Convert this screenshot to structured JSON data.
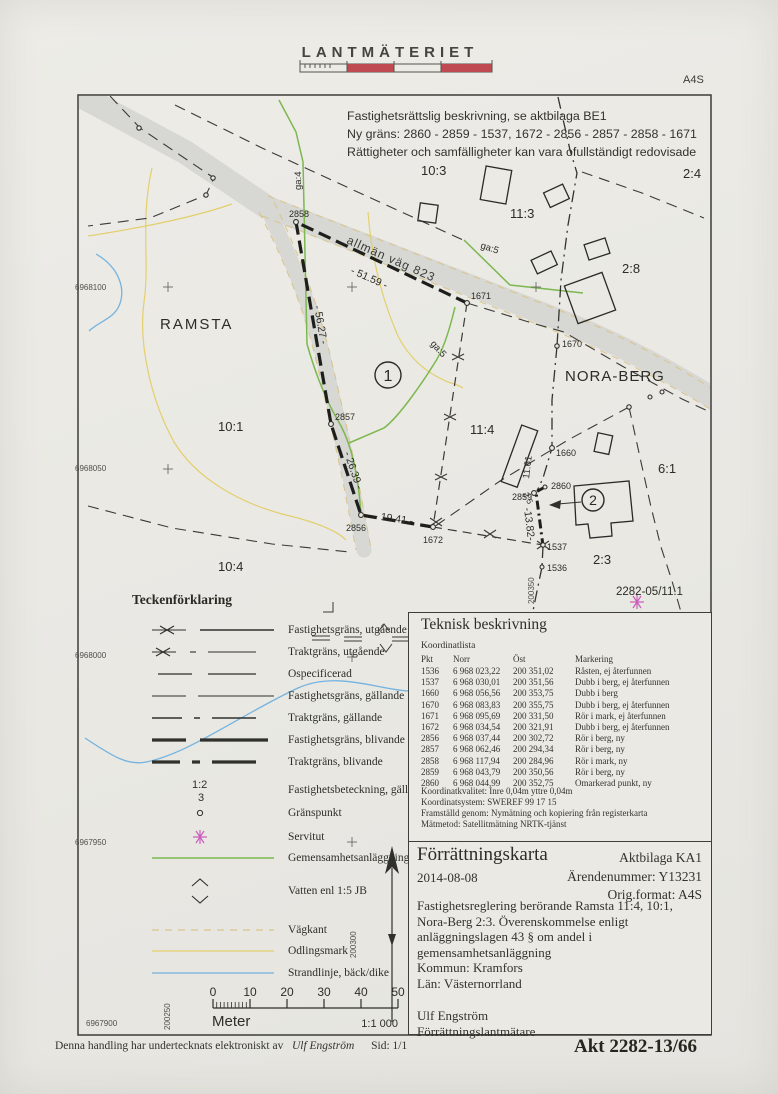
{
  "header": {
    "logo": "LANTMÄTERIET",
    "format": "A4S"
  },
  "notice": {
    "line1": "Fastighetsrättslig beskrivning, se aktbilaga BE1",
    "line2": "Ny gräns: 2860 - 2859 - 1537, 1672 - 2856 - 2857 - 2858 - 1671",
    "line3": "Rättigheter och samfälligheter kan vara ofullständigt redovisade"
  },
  "colors": {
    "ink": "#30302c",
    "road": "#d7d7d3",
    "green": "#7cb84f",
    "yellow": "#e3cf6e",
    "blue": "#74b3e0",
    "tan": "#d9c48a",
    "pink": "#c95cbc",
    "red": "#c04a52"
  },
  "map": {
    "labels": [
      {
        "t": "10:3",
        "k": "place",
        "x": 421,
        "y": 175
      },
      {
        "t": "2:4",
        "k": "place",
        "x": 683,
        "y": 178
      },
      {
        "t": "11:3",
        "k": "place",
        "x": 510,
        "y": 218
      },
      {
        "t": "2:8",
        "k": "place",
        "x": 622,
        "y": 273
      },
      {
        "t": "RAMSTA",
        "k": "place",
        "x": 160,
        "y": 329,
        "s": 15,
        "sp": 2
      },
      {
        "t": "NORA-BERG",
        "k": "place",
        "x": 565,
        "y": 381,
        "s": 15,
        "sp": 1
      },
      {
        "t": "10:1",
        "k": "place",
        "x": 218,
        "y": 431
      },
      {
        "t": "11:4",
        "k": "place",
        "x": 470,
        "y": 434
      },
      {
        "t": "6:1",
        "k": "place",
        "x": 658,
        "y": 473
      },
      {
        "t": "10:4",
        "k": "place",
        "x": 218,
        "y": 571
      },
      {
        "t": "2:3",
        "k": "place",
        "x": 593,
        "y": 564
      },
      {
        "t": "2282-05/11.1",
        "k": "place",
        "x": 616,
        "y": 595,
        "s": 11.5
      },
      {
        "t": "allmän väg 823",
        "k": "road",
        "x": 346,
        "y": 243,
        "r": 24
      },
      {
        "t": "ga:4",
        "k": "ga",
        "x": 301,
        "y": 190,
        "r": -90
      },
      {
        "t": "ga:5",
        "k": "ga",
        "x": 480,
        "y": 248,
        "r": 18
      },
      {
        "t": "ga:5",
        "k": "ga",
        "x": 430,
        "y": 344,
        "r": 48
      },
      {
        "t": "2858",
        "k": "point",
        "x": 289,
        "y": 217
      },
      {
        "t": "1671",
        "k": "point",
        "x": 471,
        "y": 299
      },
      {
        "t": "1670",
        "k": "point",
        "x": 562,
        "y": 347
      },
      {
        "t": "2857",
        "k": "point",
        "x": 335,
        "y": 420
      },
      {
        "t": "1660",
        "k": "point",
        "x": 556,
        "y": 456
      },
      {
        "t": "2856",
        "k": "point",
        "x": 346,
        "y": 531
      },
      {
        "t": "1672",
        "k": "point",
        "x": 423,
        "y": 543
      },
      {
        "t": "2859",
        "k": "point",
        "x": 512,
        "y": 500
      },
      {
        "t": "2860",
        "k": "point",
        "x": 551,
        "y": 489
      },
      {
        "t": "1537",
        "k": "point",
        "x": 547,
        "y": 550
      },
      {
        "t": "1536",
        "k": "point",
        "x": 547,
        "y": 571
      },
      {
        "t": "- 51.59 -",
        "k": "meas",
        "x": 350,
        "y": 273,
        "r": 24
      },
      {
        "t": "- 56.27 -",
        "k": "meas",
        "x": 314,
        "y": 306,
        "r": 80
      },
      {
        "t": "- 26.39 -",
        "k": "meas",
        "x": 344,
        "y": 453,
        "r": 71
      },
      {
        "t": "- 19.41 -",
        "k": "meas",
        "x": 374,
        "y": 519,
        "r": 8
      },
      {
        "t": "-13.82-",
        "k": "meas",
        "x": 524,
        "y": 508,
        "r": 83
      },
      {
        "t": "2.5",
        "k": "meas",
        "x": 523,
        "y": 494,
        "r": 65,
        "s": 8.5
      },
      {
        "t": "11.61",
        "k": "meas",
        "x": 529,
        "y": 479,
        "r": -83,
        "s": 9.5
      },
      {
        "t": "6968100",
        "k": "grid",
        "x": 75,
        "y": 290
      },
      {
        "t": "6968050",
        "k": "grid",
        "x": 75,
        "y": 471
      },
      {
        "t": "6968000",
        "k": "grid",
        "x": 75,
        "y": 658
      },
      {
        "t": "6967950",
        "k": "grid",
        "x": 75,
        "y": 845
      },
      {
        "t": "6967900",
        "k": "grid",
        "x": 86,
        "y": 1026
      },
      {
        "t": "200250",
        "k": "grid",
        "x": 170,
        "y": 1030,
        "r": -90
      },
      {
        "t": "200300",
        "k": "grid",
        "x": 356,
        "y": 958,
        "r": -90
      },
      {
        "t": "200350",
        "k": "grid",
        "x": 534,
        "y": 604,
        "r": -90
      }
    ],
    "circled": [
      {
        "t": "1",
        "x": 388,
        "y": 375,
        "rad": 13
      },
      {
        "t": "2",
        "x": 593,
        "y": 500,
        "rad": 11
      }
    ]
  },
  "legend": {
    "title": "Teckenförklaring",
    "items": [
      {
        "sym": "x-solid",
        "label": "Fastighetsgräns, utgående"
      },
      {
        "sym": "x-dashdot",
        "label": "Traktgräns, utgående"
      },
      {
        "sym": "dash-short",
        "label": "Ospecificerad"
      },
      {
        "sym": "dash-long",
        "label": "Fastighetsgräns, gällande"
      },
      {
        "sym": "dashdot-thin",
        "label": "Traktgräns, gällande"
      },
      {
        "sym": "dash-thick",
        "label": "Fastighetsgräns, blivande"
      },
      {
        "sym": "dashdot-thick",
        "label": "Traktgräns, blivande"
      },
      {
        "sym": "beteckning",
        "label": "Fastighetsbeteckning, gällande",
        "sym_text": [
          "1:2",
          "3"
        ]
      },
      {
        "sym": "circle",
        "label": "Gränspunkt"
      },
      {
        "sym": "asterisk",
        "label": "Servitut"
      },
      {
        "sym": "line-green",
        "label": "Gemensamhetsanläggning"
      },
      {
        "sym": "chevrons",
        "label": "Vatten enl 1:5 JB"
      },
      {
        "sym": "dash-tan",
        "label": "Vägkant"
      },
      {
        "sym": "line-yellow",
        "label": "Odlingsmark"
      },
      {
        "sym": "line-blue",
        "label": "Strandlinje, bäck/dike"
      }
    ]
  },
  "technical": {
    "title": "Teknisk beskrivning",
    "list_title": "Koordinatlista",
    "columns": [
      "Pkt",
      "Norr",
      "Öst",
      "Markering"
    ],
    "rows": [
      [
        "1536",
        "6 968 023,22",
        "200 351,02",
        "Råsten, ej återfunnen"
      ],
      [
        "1537",
        "6 968 030,01",
        "200 351,56",
        "Dubb i berg, ej återfunnen"
      ],
      [
        "1660",
        "6 968 056,56",
        "200 353,75",
        "Dubb i berg"
      ],
      [
        "1670",
        "6 968 083,83",
        "200 355,75",
        "Dubb i berg, ej återfunnen"
      ],
      [
        "1671",
        "6 968 095,69",
        "200 331,50",
        "Rör i mark, ej återfunnen"
      ],
      [
        "1672",
        "6 968 034,54",
        "200 321,91",
        "Dubb i berg, ej återfunnen"
      ],
      [
        "2856",
        "6 968 037,44",
        "200 302,72",
        "Rör i berg, ny"
      ],
      [
        "2857",
        "6 968 062,46",
        "200 294,34",
        "Rör i berg, ny"
      ],
      [
        "2858",
        "6 968 117,94",
        "200 284,96",
        "Rör i mark, ny"
      ],
      [
        "2859",
        "6 968 043,79",
        "200 350,56",
        "Rör i berg, ny"
      ],
      [
        "2860",
        "6 968 044,99",
        "200 352,75",
        "Omarkerad punkt, ny"
      ]
    ],
    "notes": [
      "Koordinatkvalitet: Inre 0,04m yttre 0,04m",
      "Koordinatsystem: SWEREF 99 17 15",
      "Framställd genom: Nymätning och kopiering från registerkarta",
      "Mätmetod: Satellitmätning NRTK-tjänst"
    ]
  },
  "titleblock": {
    "title": "Förrättningskarta",
    "date": "2014-08-08",
    "right": [
      "Aktbilaga KA1",
      "Ärendenummer: Y13231",
      "Orig.format: A4S"
    ],
    "lines": [
      "Fastighetsreglering berörande Ramsta 11:4, 10:1,",
      "Nora-Berg 2:3. Överenskommelse enligt",
      "anläggningslagen 43 § om andel i",
      "gemensamhetsanläggning"
    ],
    "kommun": "Kommun: Kramfors",
    "lan": "Län: Västernorrland",
    "surveyor": "Ulf Engström",
    "surveyor_title": "Förrättningslantmätare"
  },
  "scalebar": {
    "ticks": [
      "0",
      "10",
      "20",
      "30",
      "40",
      "50"
    ],
    "unit": "Meter",
    "ratio": "1:1 000"
  },
  "footer": {
    "prefix": "Denna handling har undertecknats elektroniskt av",
    "signer": "Ulf Engström",
    "page": "Sid: 1/1",
    "akt": "Akt 2282-13/66"
  }
}
